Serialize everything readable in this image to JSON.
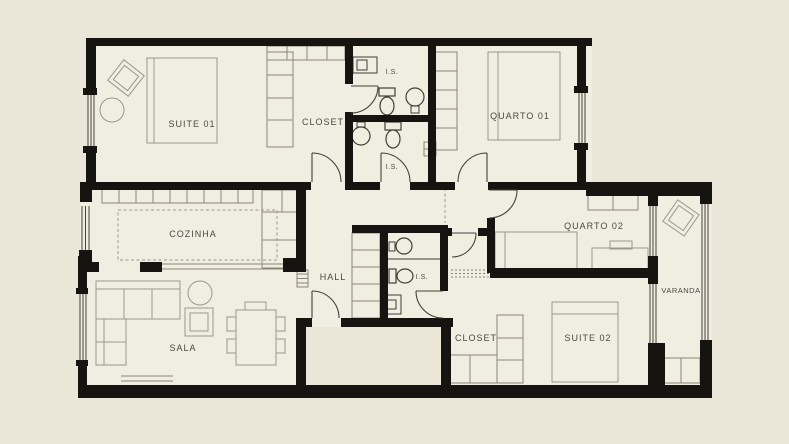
{
  "document": {
    "type": "apartment-floor-plan"
  },
  "colors": {
    "background": "#eae7d9",
    "floor": "#f0ede1",
    "wall": "#161410",
    "furniture_line": "#9a978b",
    "fixture_line": "#403e36",
    "label_text": "#4a4942"
  },
  "rooms": [
    {
      "id": "suite-01",
      "label": "SUITE 01"
    },
    {
      "id": "closet-1",
      "label": "CLOSET"
    },
    {
      "id": "is-1",
      "label": "I.S."
    },
    {
      "id": "quarto-01",
      "label": "QUARTO 01"
    },
    {
      "id": "is-2",
      "label": "I.S."
    },
    {
      "id": "cozinha",
      "label": "COZINHA"
    },
    {
      "id": "hall",
      "label": "HALL"
    },
    {
      "id": "is-3",
      "label": "I.S."
    },
    {
      "id": "quarto-02",
      "label": "QUARTO 02"
    },
    {
      "id": "varanda",
      "label": "VARANDA"
    },
    {
      "id": "sala",
      "label": "SALA"
    },
    {
      "id": "closet-2",
      "label": "CLOSET"
    },
    {
      "id": "suite-02",
      "label": "SUITE 02"
    }
  ]
}
